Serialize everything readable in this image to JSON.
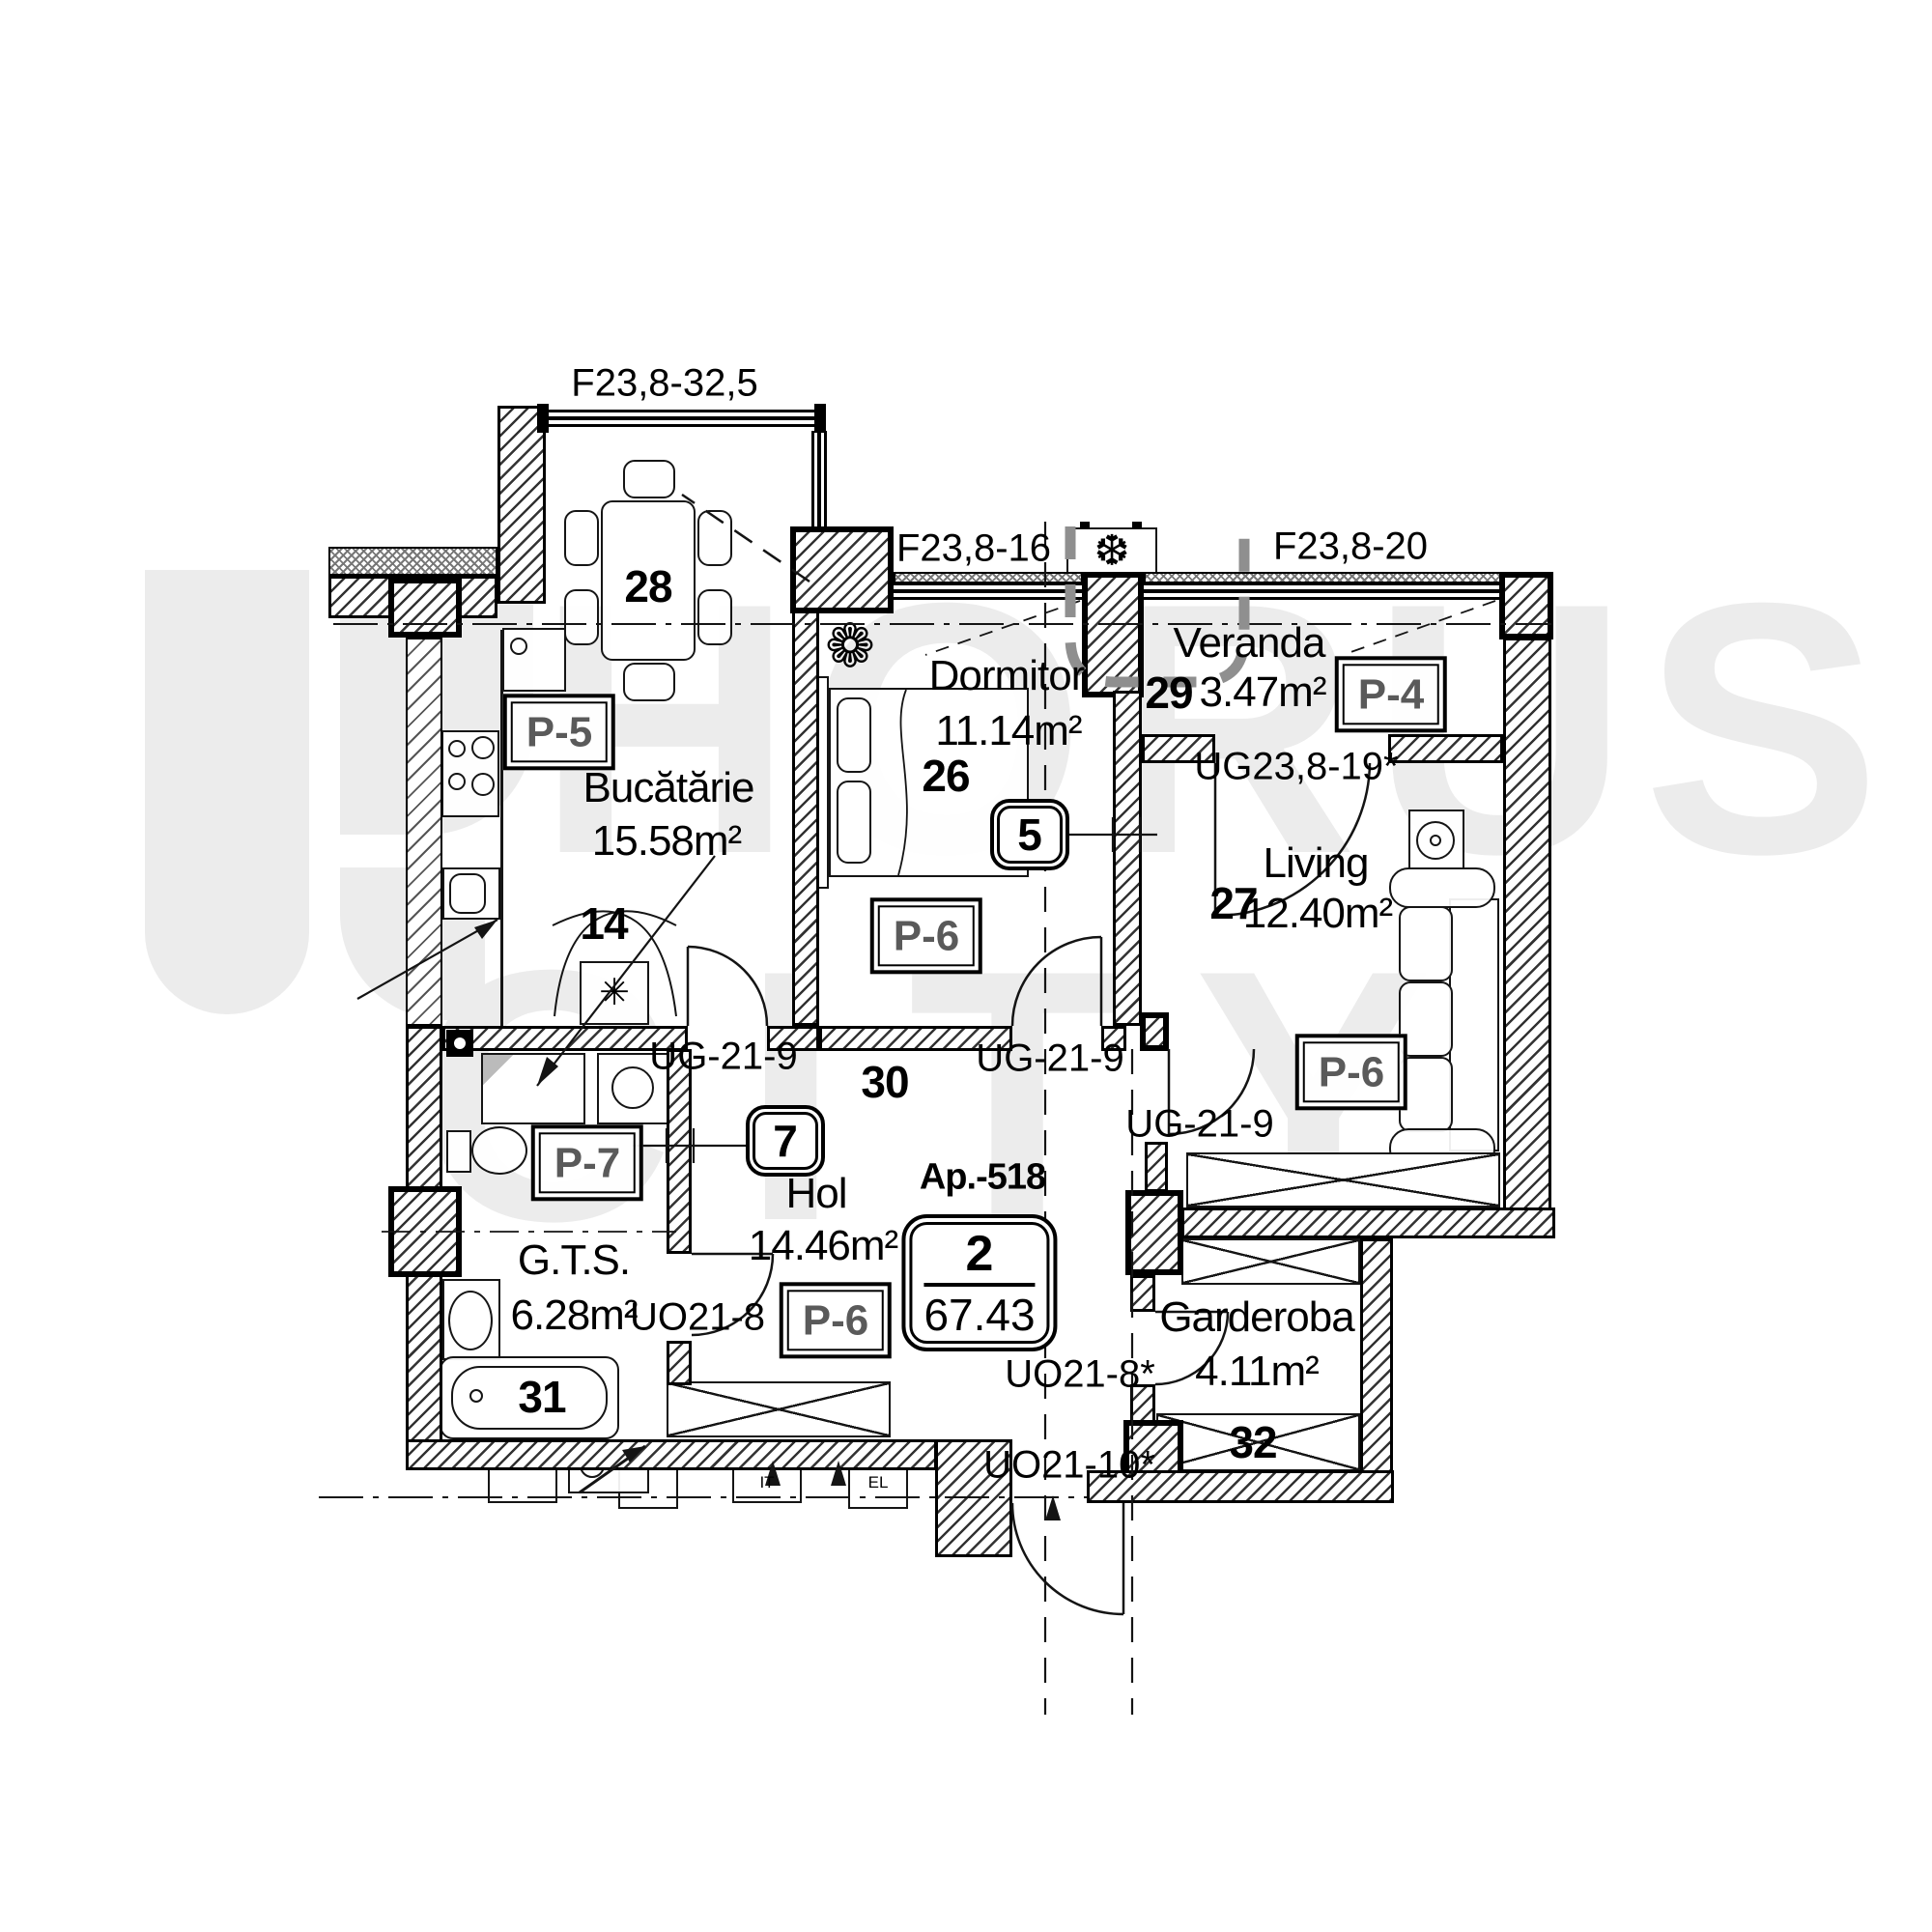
{
  "watermark": {
    "word1": "HORUS",
    "word2": "CITY"
  },
  "stamp": {
    "apartment_label": "Ap.-518",
    "rooms_count": "2",
    "total_area": "67.43"
  },
  "rooms": {
    "kitchen": {
      "name": "Bucătărie",
      "area": "15.58m²",
      "finish": "P-5",
      "dining_number": "28",
      "heater_number": "14"
    },
    "bedroom": {
      "name": "Dormitor",
      "area": "11.14m²",
      "finish": "P-6",
      "number": "26"
    },
    "veranda": {
      "name": "Veranda",
      "area": "3.47m²",
      "finish": "P-4",
      "number": "29"
    },
    "living": {
      "name": "Living",
      "area": "12.40m²",
      "finish": "P-6",
      "number": "27"
    },
    "hall": {
      "name": "Hol",
      "area": "14.46m²",
      "finish": "P-6",
      "number": "30"
    },
    "bath": {
      "name": "G.T.S.",
      "area": "6.28m²",
      "finish": "P-7",
      "tub_number": "31"
    },
    "wardrobe": {
      "name": "Garderoba",
      "area": "4.11m²",
      "number": "32"
    }
  },
  "windows": {
    "bay": "F23,8-32,5",
    "bedroom": "F23,8-16",
    "veranda": "F23,8-20",
    "veranda_living_door": "UG23,8-19*"
  },
  "doors": {
    "kitchen": "UG-21-9",
    "bedroom": "UG-21-9",
    "living": "UG-21-9",
    "bath": "UO21-8",
    "wardrobe": "UO21-8*",
    "entrance": "UO21-10*"
  },
  "wall_markers": {
    "marker5": "5",
    "marker7": "7"
  },
  "utilities": {
    "it": "IT",
    "el": "EL"
  },
  "icons": {
    "ac_unit": "❆",
    "heater": "✳",
    "plant": "❁"
  },
  "colors": {
    "line": "#141414",
    "watermark": "#ececec",
    "finish_text": "#5a5a5a",
    "gray_dash": "#8f8f8f"
  }
}
